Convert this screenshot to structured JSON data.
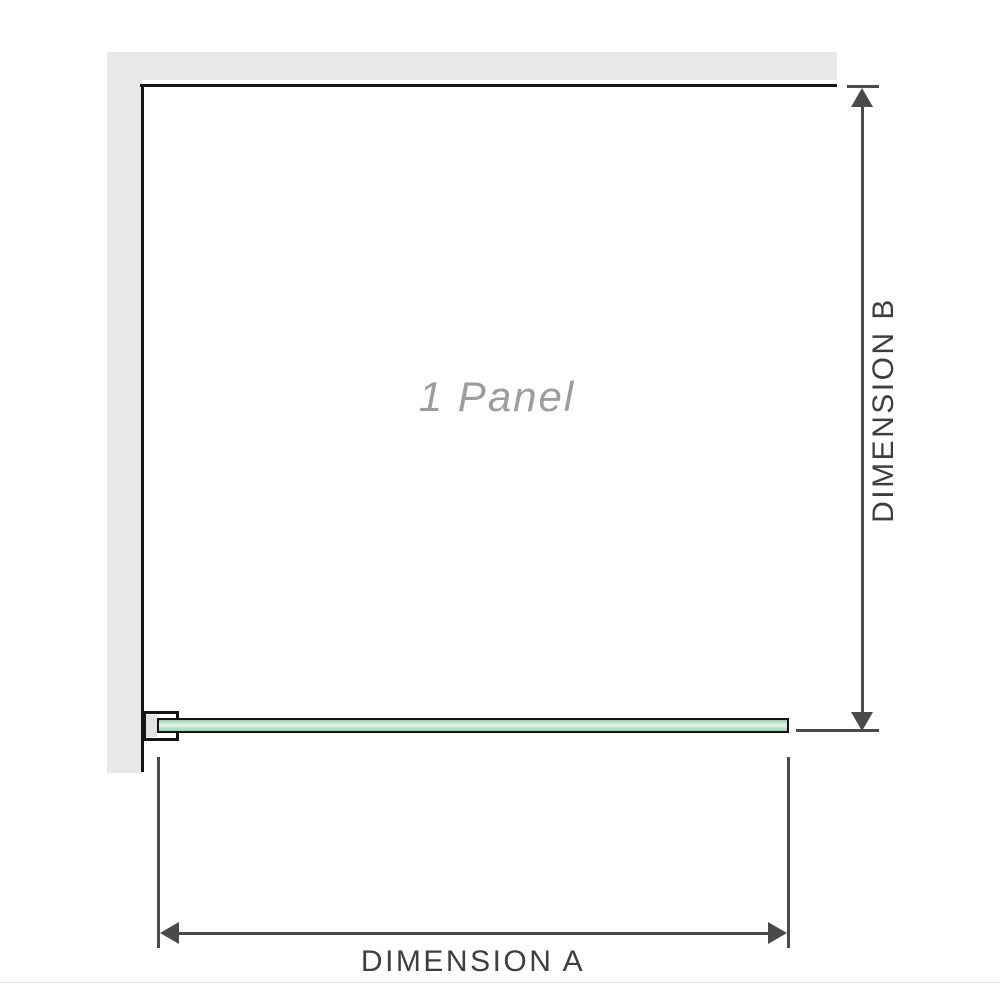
{
  "diagram": {
    "panel_label": "1 Panel",
    "dimension_a_label": "DIMENSION A",
    "dimension_b_label": "DIMENSION B"
  },
  "colors": {
    "wall_gray": "#e8e8e8",
    "frame_black": "#141414",
    "dimension_gray": "#4a4a4a",
    "label_gray": "#9d9d9d",
    "dimension_text": "#3e3e3e",
    "glass_green_dark": "#96cdaa",
    "glass_green_light": "#e7f6ee"
  }
}
